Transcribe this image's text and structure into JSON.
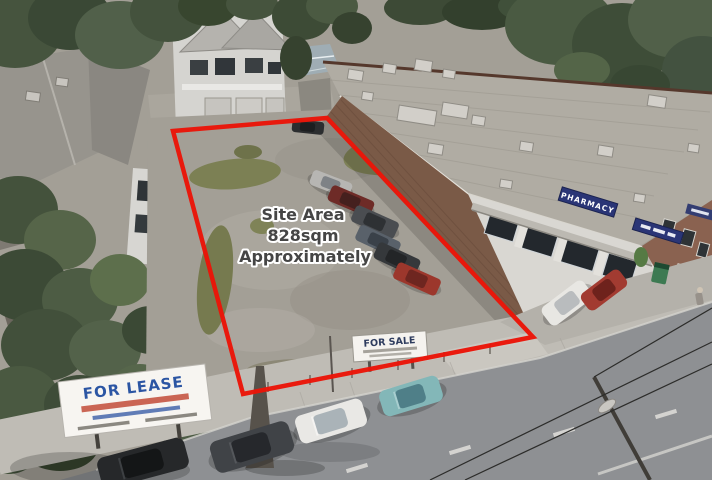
{
  "annotation": {
    "line1": "Site Area",
    "line2": "828sqm",
    "line3": "Approximately",
    "text_color": "#454545",
    "outline_color": "#ffffff",
    "boundary_color": "#ea1508",
    "boundary_points": "173,131 327,118 533,337 243,394"
  },
  "signs": {
    "pharmacy": {
      "label": "PHARMACY",
      "board_color": "#2a3576",
      "text_color": "#ffffff"
    },
    "for_sale": {
      "title": "FOR SALE",
      "title_color": "#2e3c5e",
      "board_color": "#f5f3ef"
    },
    "for_lease": {
      "title": "FOR LEASE",
      "title_color": "#2b55a3",
      "board_color": "#f7f5f1",
      "accent_color": "#c24b38"
    }
  },
  "scene": {
    "lot_ground_color": "#a39f96",
    "roof_color": "#b0aca3",
    "brick_color": "#7a5a47",
    "facade_color": "#d9d7d2",
    "road_color": "#8e9093",
    "footpath_color": "#bfbcb5",
    "tree_color": "#46543e",
    "grass_color": "#7c8054"
  }
}
